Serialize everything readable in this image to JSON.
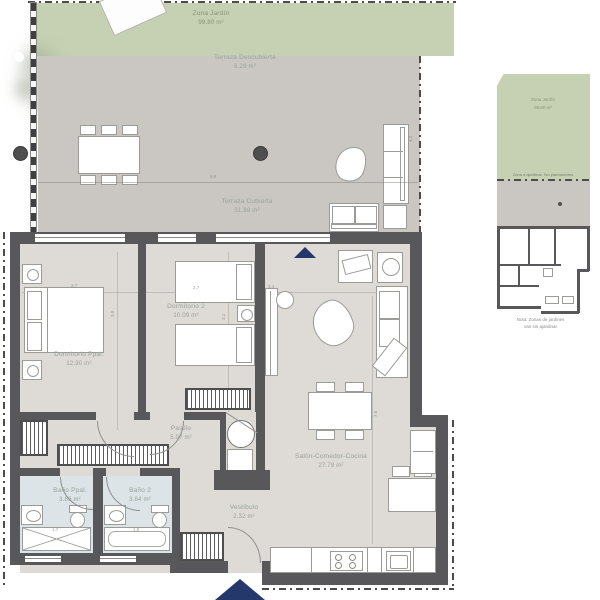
{
  "colors": {
    "wall": "#58585a",
    "floor": "#dedad6",
    "garden": "#c5d1b2",
    "terrace": "#cac6c1",
    "bath": "#dce4e7",
    "label": "#9aa29a",
    "glabel": "#879677",
    "dim": "#8f8f8c",
    "furnb": "#9b9b98",
    "arrow": "#24386b"
  },
  "rooms": {
    "zona_jardin": {
      "name": "Zona Jardín",
      "area": "99.80 m²"
    },
    "terraza_descubierta": {
      "name": "Terraza Descubierta",
      "area": "6.29 m²"
    },
    "terraza_cubierta": {
      "name": "Terraza Cubierta",
      "area": "31.88 m²"
    },
    "dormitorio_ppal": {
      "name": "Dormitorio Ppal.",
      "area": "12.90 m²"
    },
    "dormitorio_2": {
      "name": "Dormitorio 2",
      "area": "10.09 m²"
    },
    "pasillo": {
      "name": "Pasillo",
      "area": "5.07 m²"
    },
    "salon": {
      "name": "Salón-Comedor-Cocina",
      "area": "27.78 m²"
    },
    "vestibulo": {
      "name": "Vestíbulo",
      "area": "2.32 m²"
    },
    "bano_ppal": {
      "name": "Baño Ppal.",
      "area": "3.86 m²"
    },
    "bano_2": {
      "name": "Baño 2",
      "area": "3.84 m²"
    }
  },
  "dims": {
    "terrace_width": "8.9",
    "terrace_depth": "4.2",
    "dorm_ppal_width": "2.7",
    "dorm_ppal_depth": "3.0",
    "dorm2_width": "2.7",
    "dorm2_depth": "3.1",
    "salon_width": "3.4",
    "salon_depth": "7.6",
    "bano_ppal_width": "1.7",
    "bano2_width": "1.8"
  },
  "key_plan": {
    "garden": {
      "name": "Zona Jardín",
      "area": "99.80 m²"
    },
    "strip_label": "Zona a ajardinar. Sin plantaciones",
    "note_line1": "Nota: Zonas de jardines",
    "note_line2": "van sin ajardinar"
  }
}
